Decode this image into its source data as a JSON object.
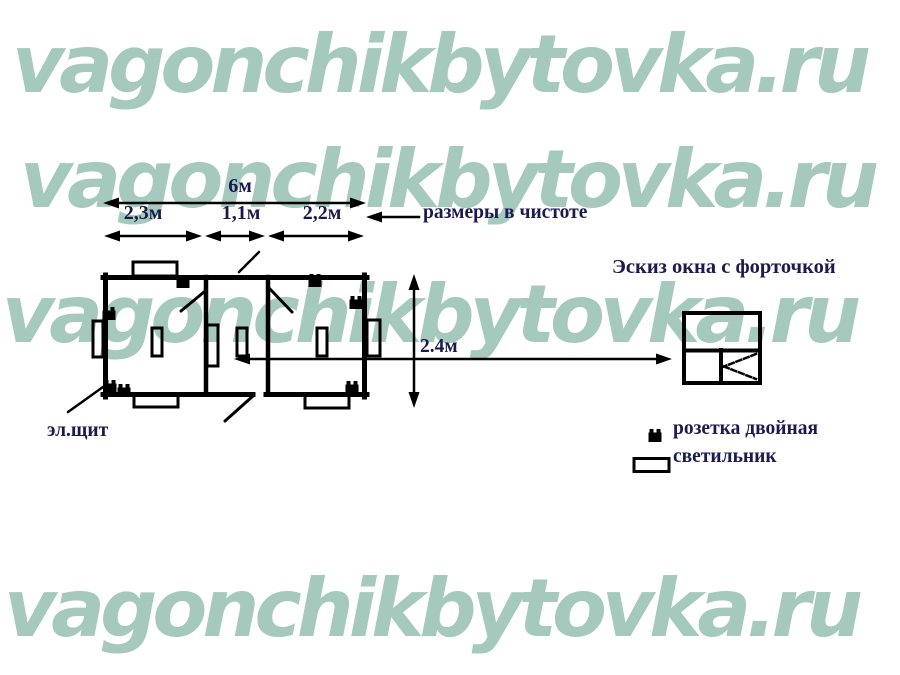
{
  "watermark": {
    "text": "vagonchikbytovka.ru"
  },
  "diagram": {
    "dimensions": {
      "total_width": "6м",
      "room_left": "2,3м",
      "room_middle": "1,1м",
      "room_right": "2,2м",
      "height": "2.4м",
      "note": "размеры в чистоте"
    },
    "labels": {
      "electrical_panel": "эл.щит",
      "window_sketch_title": "Эскиз окна с форточкой"
    },
    "legend": {
      "socket_double": "розетка двойная",
      "lamp": "светильник"
    }
  },
  "colors": {
    "watermark": "#a6c9bd",
    "label_text": "#1a1a4e",
    "line": "#000000"
  }
}
